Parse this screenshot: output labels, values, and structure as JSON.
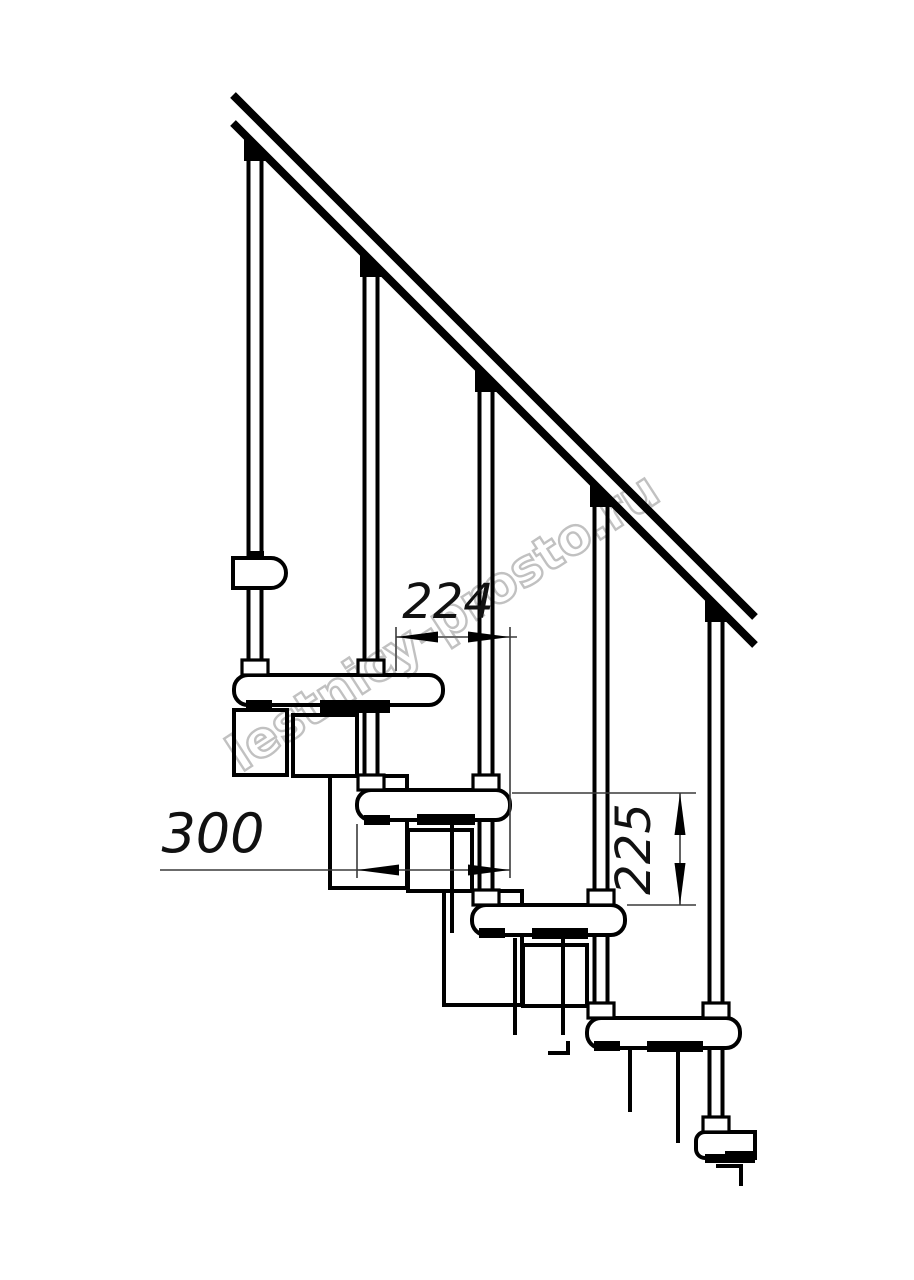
{
  "page": {
    "background": "#ffffff"
  },
  "drawing": {
    "type": "staircase-side-view-technical-drawing",
    "watermark_text": "lestnicy-prosto.ru",
    "watermark_color": "#b6b6b6",
    "line_color": "#000000",
    "dimensions": {
      "going_label": "224",
      "tread_depth_label": "300",
      "rise_label": "225"
    }
  }
}
